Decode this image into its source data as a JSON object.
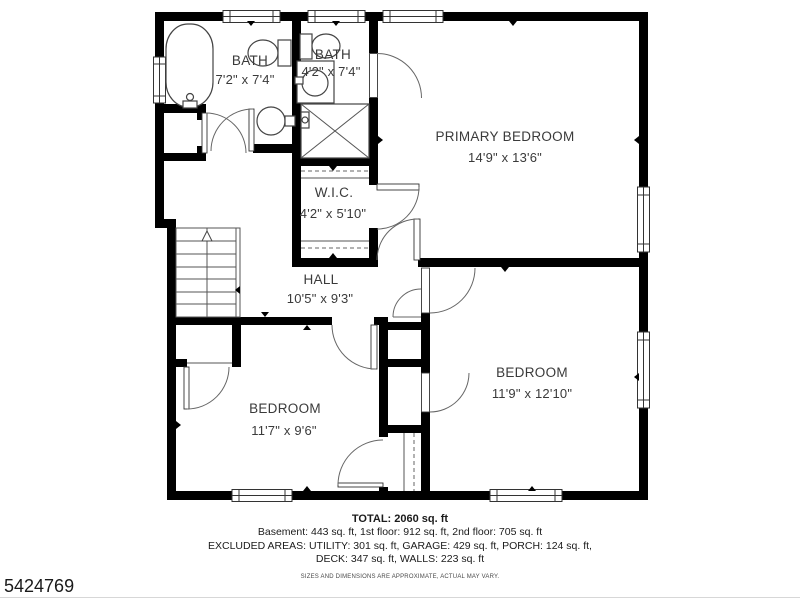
{
  "watermark": "5424769",
  "rooms": {
    "bath1": {
      "name": "BATH",
      "dims": "7'2\" x 7'4\""
    },
    "bath2": {
      "name": "BATH",
      "dims": "4'2\" x 7'4\""
    },
    "primary": {
      "name": "PRIMARY BEDROOM",
      "dims": "14'9\" x 13'6\""
    },
    "wic": {
      "name": "W.I.C.",
      "dims": "4'2\" x 5'10\""
    },
    "hall": {
      "name": "HALL",
      "dims": "10'5\" x 9'3\""
    },
    "bedroom1": {
      "name": "BEDROOM",
      "dims": "11'7\" x 9'6\""
    },
    "bedroom2": {
      "name": "BEDROOM",
      "dims": "11'9\" x 12'10\""
    }
  },
  "footer": {
    "total": "TOTAL: 2060 sq. ft",
    "line1": "Basement: 443 sq. ft, 1st floor: 912 sq. ft, 2nd floor: 705 sq. ft",
    "line2": "EXCLUDED AREAS: UTILITY: 301 sq. ft, GARAGE: 429 sq. ft, PORCH: 124 sq. ft,",
    "line3": "DECK: 347 sq. ft, WALLS: 223 sq. ft",
    "disclaimer": "SIZES AND DIMENSIONS ARE APPROXIMATE, ACTUAL MAY VARY."
  },
  "colors": {
    "wall": "#000000",
    "label": "#3a3a3a",
    "background": "#ffffff"
  }
}
